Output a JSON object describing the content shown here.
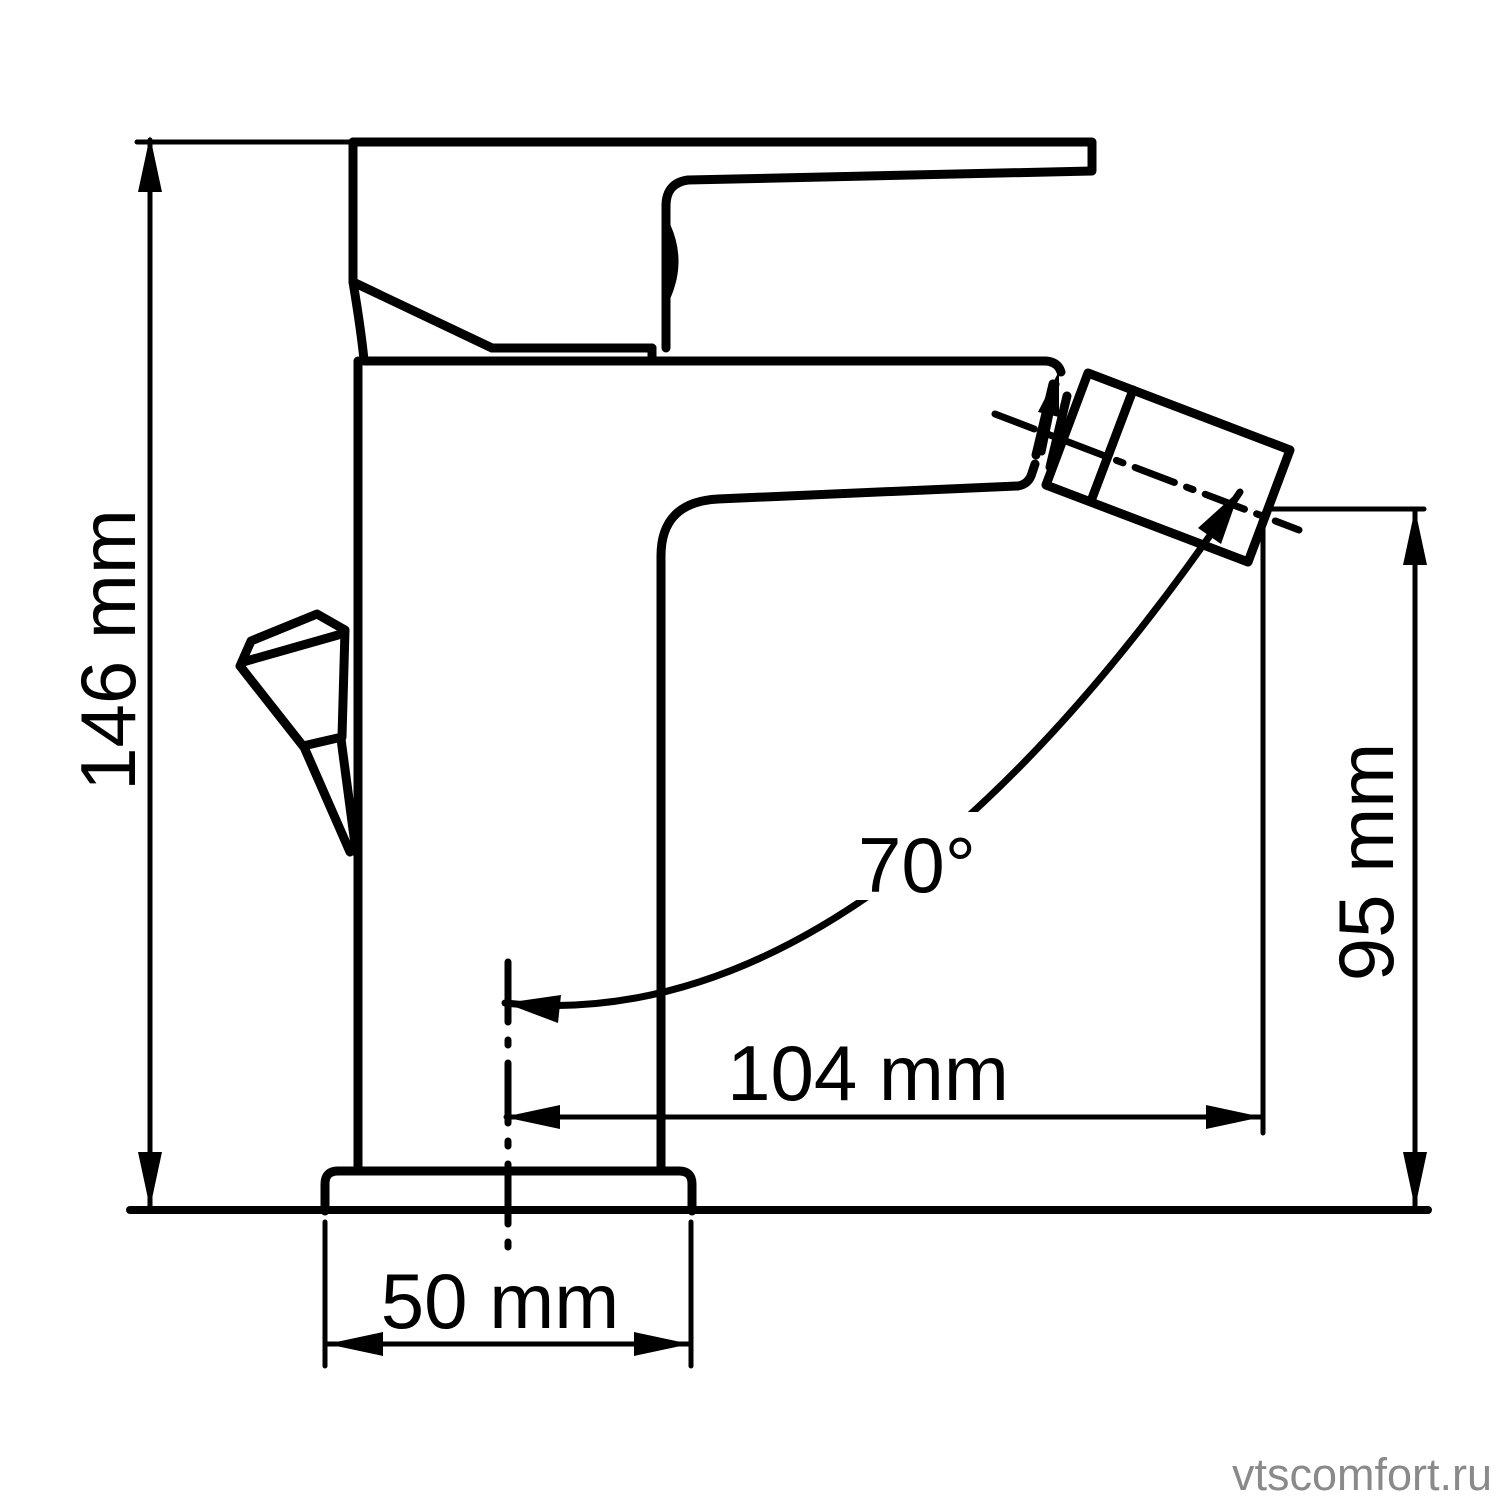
{
  "diagram": {
    "title": "bidet-single-lever-faucet-dimension-drawing",
    "dimensions": {
      "total_height": "146 mm",
      "spout_reach": "104 mm",
      "spout_height": "95 mm",
      "base_width": "50 mm",
      "aerator_angle": "70°"
    },
    "colors": {
      "line": "#000000",
      "background": "#ffffff",
      "watermark": "#8a8a8a"
    },
    "watermark": "vtscomfort.ru"
  }
}
